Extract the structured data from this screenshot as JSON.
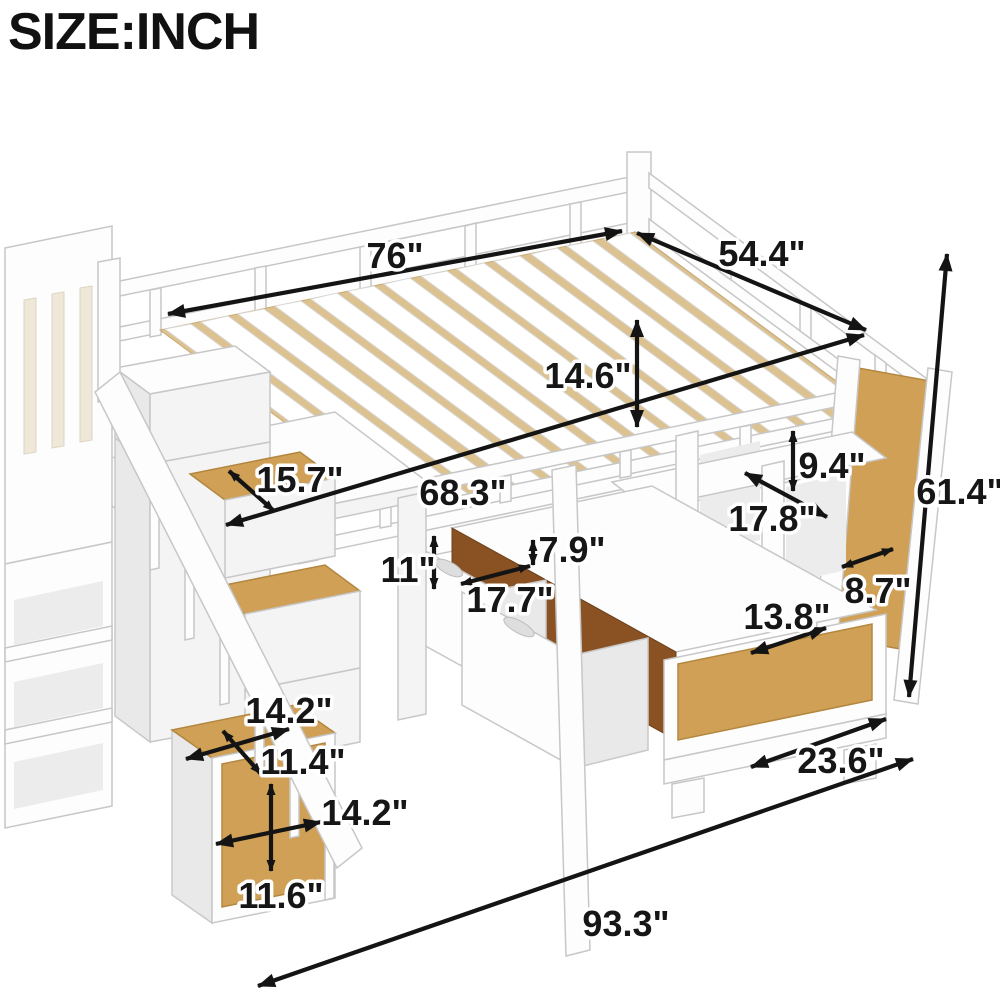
{
  "title": "SIZE:INCH",
  "dims": {
    "bed_length": "76\"",
    "bed_width": "54.4\"",
    "rail_to_deck_height": "14.6\"",
    "overall_height": "61.4\"",
    "desk_depth": "15.7\"",
    "underbed_length": "68.3\"",
    "drawer_front_height": "11\"",
    "drawer_gap_height": "7.9\"",
    "drawer_depth": "17.7\"",
    "shelf_cubby_height": "9.4\"",
    "shelf_cubby_width": "17.8\"",
    "side_frame_depth": "8.7\"",
    "lower_panel_width": "13.8\"",
    "overall_depth": "23.6\"",
    "overall_length": "93.3\"",
    "step_top_width": "14.2\"",
    "step_top_depth": "11.4\"",
    "step_front_width": "14.2\"",
    "step_front_height": "11.6\""
  },
  "colors": {
    "wood": "#cfa055",
    "wood_dark": "#8a5222",
    "slat_gap": "#ddc291",
    "dimension_line": "#141414",
    "furniture": "#fdfdfd"
  }
}
